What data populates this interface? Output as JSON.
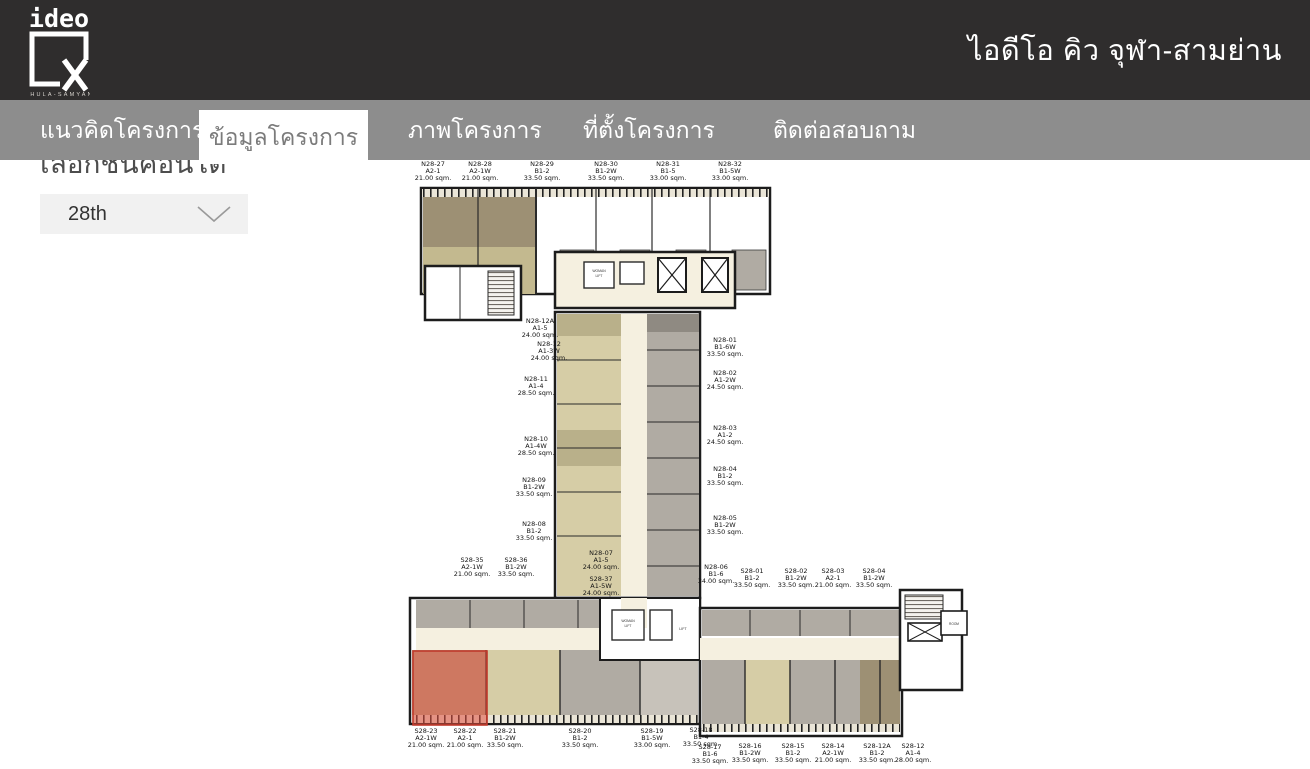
{
  "header": {
    "logo": {
      "brand": "ideo",
      "subtitle": "CHULA-SAMYAN"
    },
    "title": "ไอดีโอ คิว จุฬา-สามย่าน"
  },
  "nav": {
    "tabs": [
      {
        "label": "แนวคิดโครงการ",
        "active": false
      },
      {
        "label": "ข้อมูลโครงการ",
        "active": true
      },
      {
        "label": "ภาพโครงการ",
        "active": false
      },
      {
        "label": "ที่ตั้งโครงการ",
        "active": false
      },
      {
        "label": "ติดต่อสอบถาม",
        "active": false
      }
    ]
  },
  "floor_selector": {
    "heading": "เลือกชั้นคอนโด",
    "selected": "28th"
  },
  "floorplan": {
    "floor": "28th",
    "highlighted_units": [
      "S28-23",
      "S28-22"
    ],
    "core_labels": {
      "woman": "WOMAN",
      "lift": "LIFT",
      "room": "ROOM"
    },
    "units": [
      {
        "code": "N28-27",
        "type": "A2-1",
        "area": "21.00 sqm.",
        "x": 433,
        "y": 161
      },
      {
        "code": "N28-28",
        "type": "A2-1W",
        "area": "21.00 sqm.",
        "x": 480,
        "y": 161
      },
      {
        "code": "N28-29",
        "type": "B1-2",
        "area": "33.50 sqm.",
        "x": 542,
        "y": 161
      },
      {
        "code": "N28-30",
        "type": "B1-2W",
        "area": "33.50 sqm.",
        "x": 606,
        "y": 161
      },
      {
        "code": "N28-31",
        "type": "B1-5",
        "area": "33.00 sqm.",
        "x": 668,
        "y": 161
      },
      {
        "code": "N28-32",
        "type": "B1-5W",
        "area": "33.00 sqm.",
        "x": 730,
        "y": 161
      },
      {
        "code": "N28-12A",
        "type": "A1-5",
        "area": "24.00 sqm.",
        "x": 540,
        "y": 318
      },
      {
        "code": "N28-12",
        "type": "A1-3W",
        "area": "24.00 sqm.",
        "x": 549,
        "y": 341
      },
      {
        "code": "N28-11",
        "type": "A1-4",
        "area": "28.50 sqm.",
        "x": 536,
        "y": 376
      },
      {
        "code": "N28-10",
        "type": "A1-4W",
        "area": "28.50 sqm.",
        "x": 536,
        "y": 436
      },
      {
        "code": "N28-09",
        "type": "B1-2W",
        "area": "33.50 sqm.",
        "x": 534,
        "y": 477
      },
      {
        "code": "N28-08",
        "type": "B1-2",
        "area": "33.50 sqm.",
        "x": 534,
        "y": 521
      },
      {
        "code": "N28-07",
        "type": "A1-5",
        "area": "24.00 sqm.",
        "x": 601,
        "y": 550
      },
      {
        "code": "S28-37",
        "type": "A1-5W",
        "area": "24.00 sqm.",
        "x": 601,
        "y": 576
      },
      {
        "code": "N28-01",
        "type": "B1-6W",
        "area": "33.50 sqm.",
        "x": 725,
        "y": 337
      },
      {
        "code": "N28-02",
        "type": "A1-2W",
        "area": "24.50 sqm.",
        "x": 725,
        "y": 370
      },
      {
        "code": "N28-03",
        "type": "A1-2",
        "area": "24.50 sqm.",
        "x": 725,
        "y": 425
      },
      {
        "code": "N28-04",
        "type": "B1-2",
        "area": "33.50 sqm.",
        "x": 725,
        "y": 466
      },
      {
        "code": "N28-05",
        "type": "B1-2W",
        "area": "33.50 sqm.",
        "x": 725,
        "y": 515
      },
      {
        "code": "S28-35",
        "type": "A2-1W",
        "area": "21.00 sqm.",
        "x": 472,
        "y": 557
      },
      {
        "code": "S28-36",
        "type": "B1-2W",
        "area": "33.50 sqm.",
        "x": 516,
        "y": 557
      },
      {
        "code": "N28-06",
        "type": "B1-6",
        "area": "34.00 sqm.",
        "x": 716,
        "y": 564
      },
      {
        "code": "S28-01",
        "type": "B1-2",
        "area": "33.50 sqm.",
        "x": 752,
        "y": 568
      },
      {
        "code": "S28-02",
        "type": "B1-2W",
        "area": "33.50 sqm.",
        "x": 796,
        "y": 568
      },
      {
        "code": "S28-03",
        "type": "A2-1",
        "area": "21.00 sqm.",
        "x": 833,
        "y": 568
      },
      {
        "code": "S28-04",
        "type": "B1-2W",
        "area": "33.50 sqm.",
        "x": 874,
        "y": 568
      },
      {
        "code": "S28-23",
        "type": "A2-1W",
        "area": "21.00 sqm.",
        "x": 426,
        "y": 728,
        "highlighted": true
      },
      {
        "code": "S28-22",
        "type": "A2-1",
        "area": "21.00 sqm.",
        "x": 465,
        "y": 728,
        "highlighted": true
      },
      {
        "code": "S28-21",
        "type": "B1-2W",
        "area": "33.50 sqm.",
        "x": 505,
        "y": 728
      },
      {
        "code": "S28-20",
        "type": "B1-2",
        "area": "33.50 sqm.",
        "x": 580,
        "y": 728
      },
      {
        "code": "S28-19",
        "type": "B1-5W",
        "area": "33.00 sqm.",
        "x": 652,
        "y": 728
      },
      {
        "code": "S28-18",
        "type": "B1-4",
        "area": "33.50 sqm.",
        "x": 701,
        "y": 727
      },
      {
        "code": "S28-17",
        "type": "B1-6",
        "area": "33.50 sqm.",
        "x": 710,
        "y": 744
      },
      {
        "code": "S28-16",
        "type": "B1-2W",
        "area": "33.50 sqm.",
        "x": 750,
        "y": 743
      },
      {
        "code": "S28-15",
        "type": "B1-2",
        "area": "33.50 sqm.",
        "x": 793,
        "y": 743
      },
      {
        "code": "S28-14",
        "type": "A2-1W",
        "area": "21.00 sqm.",
        "x": 833,
        "y": 743
      },
      {
        "code": "S28-12A",
        "type": "B1-2",
        "area": "33.50 sqm.",
        "x": 877,
        "y": 743
      },
      {
        "code": "S28-12",
        "type": "A1-4",
        "area": "28.00 sqm.",
        "x": 913,
        "y": 743
      }
    ]
  },
  "colors": {
    "header_bg": "#2f2d2d",
    "nav_bg": "#8d8d8d",
    "active_tab_text": "#7b7b7b",
    "highlight_red": "#e0503f",
    "room_beige": "#d6cda6",
    "room_olive": "#b9b08a",
    "room_tan": "#9d9074",
    "room_gray": "#b0aba3"
  }
}
